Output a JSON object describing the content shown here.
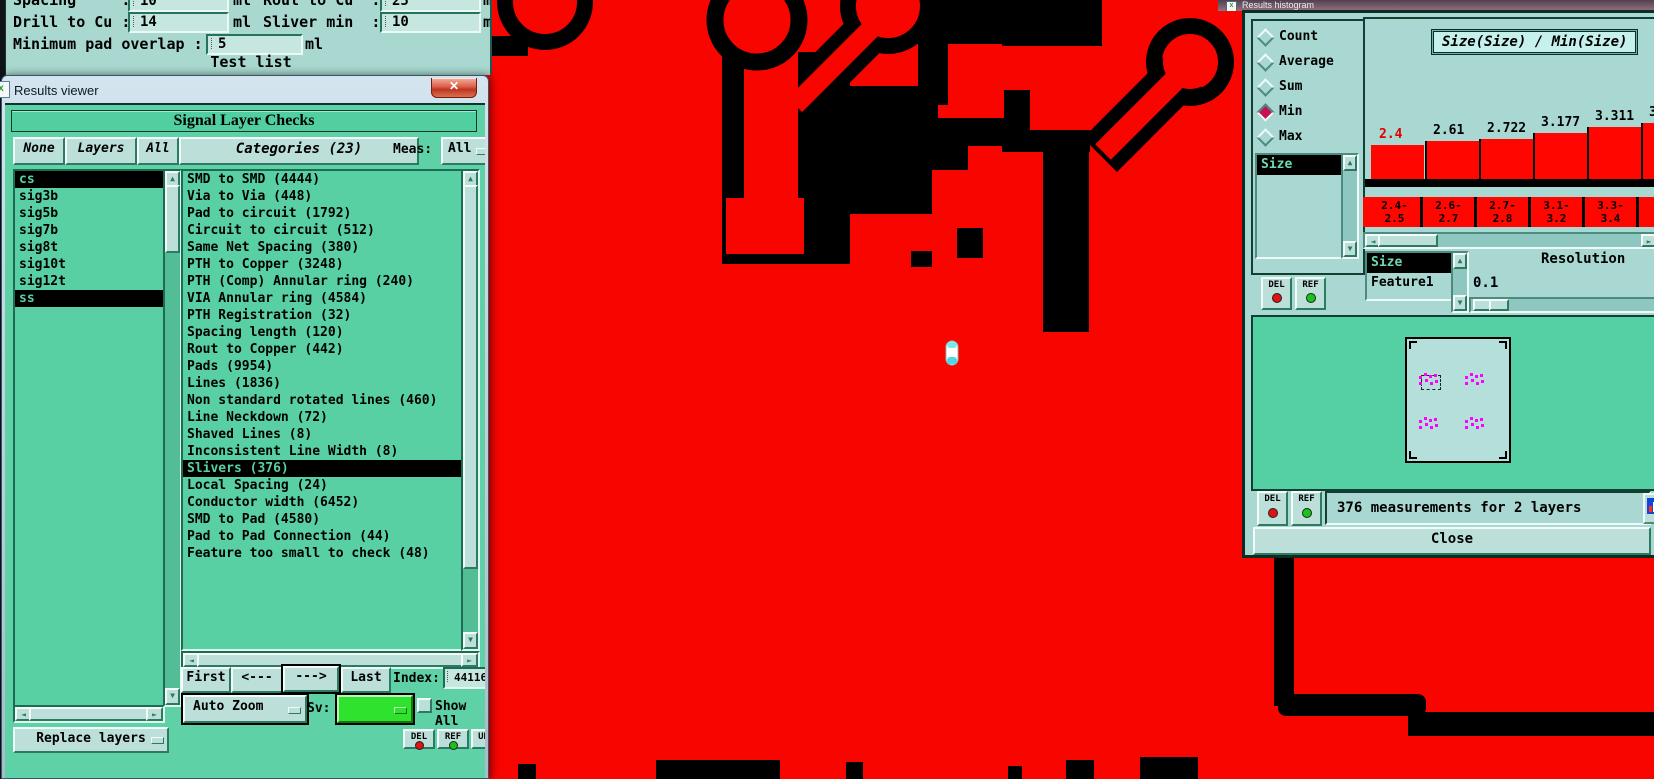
{
  "icons": {
    "close": "✕",
    "up": "▲",
    "down": "▼",
    "left": "◄",
    "right": "►",
    "win": "x"
  },
  "colors": {
    "copper": "#f90500",
    "trace_black": "#000000",
    "selection_bg": "#000000",
    "bar_red": "#ff0600",
    "first_bar_label": "#e00000",
    "sv_green": "#2ee22e",
    "magenta": "#ff00ff",
    "radio_selected": "#c81050",
    "sliver_cyan": "#49d9e2"
  },
  "param_dialog": {
    "row1": {
      "label": "Spacing     :",
      "value": "10",
      "unit": "ml",
      "label2": "Rout to Cu  :",
      "value2": "25",
      "unit2": "ml"
    },
    "row2": {
      "label": "Drill to Cu :",
      "value": "14",
      "unit": "ml",
      "label2": "Sliver min  :",
      "value2": "10",
      "unit2": "ml"
    },
    "row3": {
      "label": "Minimum pad overlap :",
      "value": "5",
      "unit": "ml"
    },
    "test_list_label": "Test list"
  },
  "results_viewer": {
    "title": "Results viewer",
    "header": "Signal Layer Checks",
    "buttons": {
      "none": "None",
      "layers": "Layers",
      "all": "All"
    },
    "categories_header": "Categories (23)",
    "meas_label": "Meas:",
    "meas_value": "All",
    "layers": [
      {
        "name": "cs",
        "selected": true
      },
      {
        "name": "sig3b",
        "selected": false
      },
      {
        "name": "sig5b",
        "selected": false
      },
      {
        "name": "sig7b",
        "selected": false
      },
      {
        "name": "sig8t",
        "selected": false
      },
      {
        "name": "sig10t",
        "selected": false
      },
      {
        "name": "sig12t",
        "selected": false
      },
      {
        "name": "ss",
        "selected": true
      }
    ],
    "categories": [
      {
        "name": "SMD to SMD (4444)",
        "selected": false
      },
      {
        "name": "Via to Via (448)",
        "selected": false
      },
      {
        "name": "Pad to circuit (1792)",
        "selected": false
      },
      {
        "name": "Circuit to circuit (512)",
        "selected": false
      },
      {
        "name": "Same Net Spacing (380)",
        "selected": false
      },
      {
        "name": "PTH to Copper (3248)",
        "selected": false
      },
      {
        "name": "PTH (Comp) Annular ring (240)",
        "selected": false
      },
      {
        "name": "VIA Annular ring (4584)",
        "selected": false
      },
      {
        "name": "PTH Registration (32)",
        "selected": false
      },
      {
        "name": "Spacing length (120)",
        "selected": false
      },
      {
        "name": "Rout to Copper (442)",
        "selected": false
      },
      {
        "name": "Pads (9954)",
        "selected": false
      },
      {
        "name": "Lines (1836)",
        "selected": false
      },
      {
        "name": "Non standard rotated lines (460)",
        "selected": false
      },
      {
        "name": "Line Neckdown (72)",
        "selected": false
      },
      {
        "name": "Shaved Lines (8)",
        "selected": false
      },
      {
        "name": "Inconsistent Line Width (8)",
        "selected": false
      },
      {
        "name": "Slivers (376)",
        "selected": true
      },
      {
        "name": "Local Spacing (24)",
        "selected": false
      },
      {
        "name": "Conductor width (6452)",
        "selected": false
      },
      {
        "name": "SMD to Pad (4580)",
        "selected": false
      },
      {
        "name": "Pad to Pad Connection (44)",
        "selected": false
      },
      {
        "name": "Feature too small to check (48)",
        "selected": false
      }
    ],
    "nav": {
      "first": "First",
      "prev": "<---",
      "next": "--->",
      "last": "Last",
      "index_label": "Index:",
      "index_value": "44116"
    },
    "options": {
      "auto_zoom": "Auto Zoom",
      "sv_label": "Sv:",
      "show_all": "Show All",
      "show_all_checked": false
    },
    "replace_layers": "Replace layers",
    "mini_buttons": [
      "DEL",
      "REF",
      "UNDO"
    ]
  },
  "histogram_window": {
    "title": "Results histogram",
    "stat_options": [
      {
        "label": "Count",
        "selected": false
      },
      {
        "label": "Average",
        "selected": false
      },
      {
        "label": "Sum",
        "selected": false
      },
      {
        "label": "Min",
        "selected": true
      },
      {
        "label": "Max",
        "selected": false
      }
    ],
    "series_list": [
      {
        "name": "Size",
        "selected": true
      }
    ],
    "chart_title": "Size(Size) / Min(Size)",
    "attr_list": [
      {
        "name": "Size",
        "selected": true
      },
      {
        "name": "Feature1",
        "selected": false
      }
    ],
    "resolution_label": "Resolution",
    "resolution_value": "0.1",
    "del_label": "DEL",
    "ref_label": "REF",
    "status": "376 measurements for 2 layers",
    "close_label": "Close",
    "preview": {
      "cluster_positions": [
        [
          12,
          34
        ],
        [
          58,
          34
        ],
        [
          12,
          78
        ],
        [
          58,
          78
        ]
      ],
      "dot_offsets": [
        [
          0,
          3
        ],
        [
          0,
          9
        ],
        [
          5,
          0
        ],
        [
          6,
          6
        ],
        [
          10,
          2
        ],
        [
          11,
          9
        ],
        [
          15,
          1
        ],
        [
          16,
          7
        ]
      ]
    }
  },
  "chart_data": {
    "type": "bar",
    "title": "Size(Size) / Min(Size)",
    "stat_mode": "Min",
    "categories": [
      "2.4-2.5",
      "2.6-2.7",
      "2.7-2.8",
      "3.1-3.2",
      "3.3-3.4",
      "3.(clipped)"
    ],
    "bin_labels_two_line": [
      [
        "2.4-",
        "2.5"
      ],
      [
        "2.6-",
        "2.7"
      ],
      [
        "2.7-",
        "2.8"
      ],
      [
        "3.1-",
        "3.2"
      ],
      [
        "3.3-",
        "3.4"
      ],
      [
        "3.",
        ""
      ]
    ],
    "values": [
      2.4,
      2.61,
      2.722,
      3.177,
      3.311,
      null
    ],
    "value_labels": [
      "2.4",
      "2.61",
      "2.722",
      "3.177",
      "3.311",
      "3."
    ],
    "bar_heights_px": [
      34,
      38,
      40,
      46,
      52,
      56
    ],
    "ylabel": "Min(Size)",
    "xlabel": "Size bins",
    "legend": "none",
    "grid": false,
    "resolution": "0.1",
    "note": "sixth bar and label clipped at right screen edge"
  }
}
